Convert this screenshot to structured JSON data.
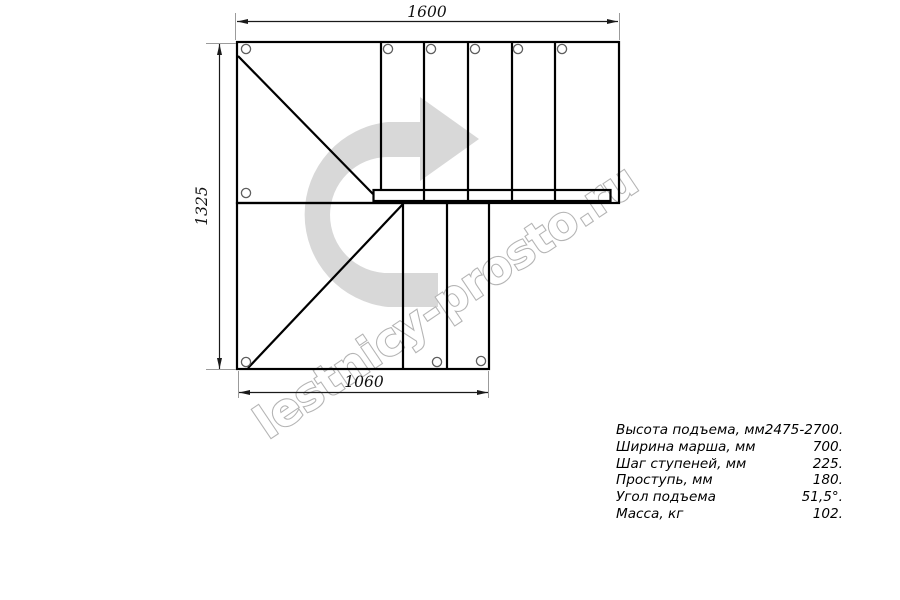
{
  "drawing": {
    "title": "staircase-plan-top-view",
    "dimensions": {
      "top_width_mm": "1600",
      "left_height_mm": "1325",
      "bottom_width_mm": "1060"
    },
    "watermark": {
      "text": "lestnicy-prosto.ru",
      "arrow_icon": "u-turn-right-arrow",
      "arrow_color": "#d8d8d8",
      "outline_color": "#b4b4b4"
    },
    "colors": {
      "outline": "#000000",
      "dimension_line": "#1a1a1a",
      "extension_line": "#9b9b9b",
      "hole_stroke": "#5f5f5f",
      "background": "#ffffff"
    }
  },
  "specs": {
    "rows": [
      {
        "label": "Высота подъема, мм",
        "value": "2475-2700."
      },
      {
        "label": "Ширина марша, мм",
        "value": "700."
      },
      {
        "label": "Шаг ступеней, мм",
        "value": "225."
      },
      {
        "label": "Проступь, мм",
        "value": "180."
      },
      {
        "label": "Угол подъема",
        "value": "51,5°."
      },
      {
        "label": "Масса, кг",
        "value": "102."
      }
    ]
  }
}
